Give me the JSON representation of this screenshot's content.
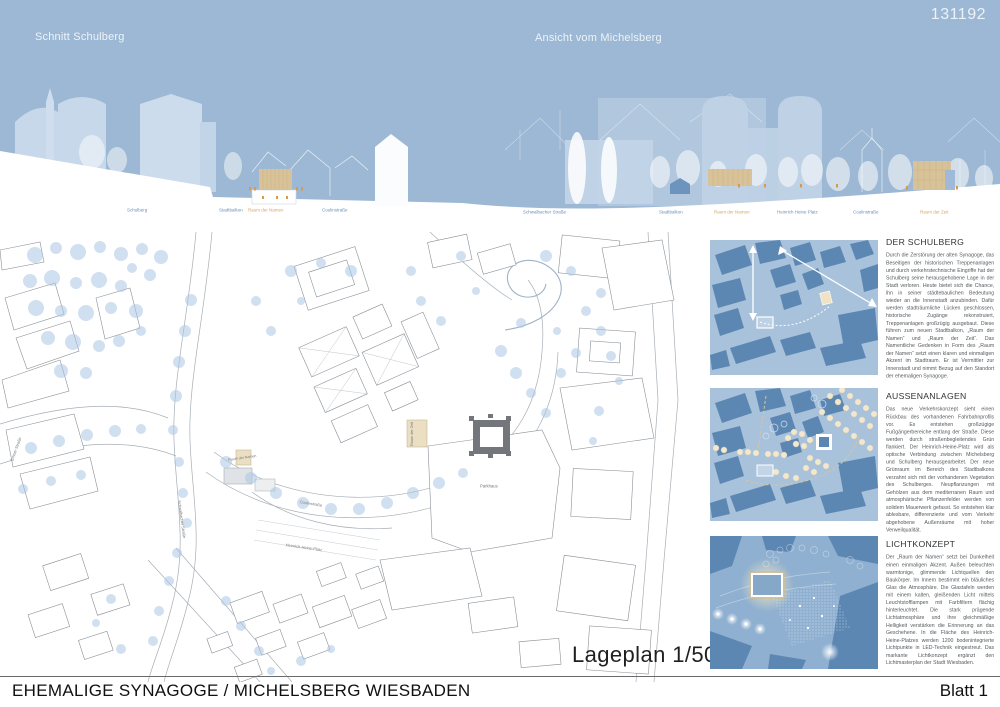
{
  "meta": {
    "competition_number": "131192",
    "project_title": "EHEMALIGE SYNAGOGE / MICHELSBERG WIESBADEN",
    "sheet": "Blatt 1"
  },
  "colors": {
    "sky": "#9cb8d4",
    "silhouette_light": "#c6d8ea",
    "accent_tan": "#d8c299",
    "label_blue": "#6b8fbc",
    "label_orange": "#d9a55f",
    "plan_tree_blue": "#a9c6e3",
    "thumb_building_blue": "#5d87b3"
  },
  "sections": {
    "left": {
      "title": "Schnitt Schulberg",
      "labels": [
        {
          "text": "Schulberg"
        },
        {
          "text": "Stadtbalkon"
        },
        {
          "text": "Raum der Namen"
        },
        {
          "text": "Coulinstraße"
        }
      ]
    },
    "right": {
      "title": "Ansicht vom Michelsberg",
      "labels": [
        {
          "text": "Schwalbacher Straße"
        },
        {
          "text": "Stadtbalkon"
        },
        {
          "text": "Raum der Namen"
        },
        {
          "text": "Heinrich Heine Platz"
        },
        {
          "text": "Coulinstraße"
        },
        {
          "text": "Raum der Zeit"
        }
      ]
    }
  },
  "siteplan": {
    "caption": "Lageplan 1/500",
    "labels": {
      "parkhaus": "Parkhaus",
      "raum_der_zeit": "Raum der Zeit",
      "raum_der_namen": "Raum der Namen",
      "schwalbacher": "Schwalbacher Straße",
      "emser": "Emser Straße",
      "coulin": "Coulinstraße",
      "hh_platz": "Heinrich-Heine-Platz"
    }
  },
  "panels": [
    {
      "heading": "DER SCHULBERG",
      "body": "Durch die Zerstörung der alten Synagoge, das Beseitigen der historischen Treppenanlagen und durch verkehrstechnische Eingriffe hat der Schulberg seine herausgehobene Lage in der Stadt verloren. Heute bietet sich die Chance, ihn in seiner städtebaulichen Bedeutung wieder an die Innenstadt anzubinden. Dafür werden stadträumliche Lücken geschlossen, historische Zugänge rekonstruiert, Treppenanlagen großzügig ausgebaut. Diese führen zum neuen Stadtbalkon, „Raum der Namen“ und „Raum der Zeit“. Das Namentliche Gedenken in Form des „Raum der Namen“ setzt einen klaren und einmaligen Akzent im Stadtraum. Er ist Vermittler zur Innenstadt und nimmt Bezug auf den Standort der ehemaligen Synagoge."
    },
    {
      "heading": "AUSSENANLAGEN",
      "body": "Das neue Verkehrskonzept sieht einen Rückbau des vorhandenen Fahrbahnprofils vor. Es entstehen großzügige Fußgängerbereiche entlang der Straße. Diese werden durch straßenbegleitendes Grün flankiert. Der Heinrich-Heine-Platz wird als optische Verbindung zwischen Michelsberg und Schulberg herausgearbeitet. Der neue Grünraum im Bereich des Stadtbalkons verzahnt sich mit der vorhandenen Vegetation des Schulberges. Neupflanzungen mit Gehölzen aus dem mediterranen Raum und atmosphärische Pflanzenfelder werden von solidem Mauerwerk gefasst. So entstehen klar ablesbare, differenzierte und vom Verkehr abgehobene Außenräume mit hoher Verweilqualität."
    },
    {
      "heading": "LICHTKONZEPT",
      "body": "Der „Raum der Namen“ setzt bei Dunkelheit einen einmaligen Akzent. Außen beleuchten warmtonige, glimmende Lichtquellen den Baukörper. Im Innern bestimmt ein bläuliches Glas die Atmosphäre. Die Glastafeln werden mit einem kalten, gleißenden Licht mittels Leuchtstofflampen mit Farbfiltern flächig hinterleuchtet. Die stark prägende Lichtatmosphäre und ihre gleichmäßige Helligkeit verstärken die Erinnerung an das Geschehene. In die Fläche des Heinrich-Heine-Platzes werden 1200 bodenintegrierte Lichtpunkte in LED-Technik eingestreut. Das markante Lichtkonzept ergänzt den Lichtmasterplan der Stadt Wiesbaden."
    }
  ]
}
